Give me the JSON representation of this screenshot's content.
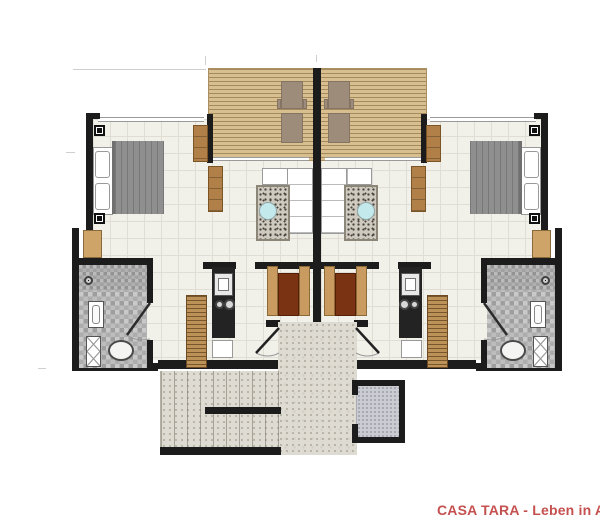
{
  "branding": {
    "title": "CASA TARA - Leben in Asien",
    "color": "#c4514f"
  },
  "palette": {
    "wall": "#1c1c1c",
    "floor": "#f2f1e9",
    "floor_grid": "#e0ded4",
    "deck_wood": "#d8bf8f",
    "lounger": "#9c8c79",
    "furniture_wood": "#b08048",
    "ladder_wood": "#bd9258",
    "table_wood": "#7b3413",
    "bench_wood": "#c99b60",
    "closet_wood": "#cfa468",
    "bed_blanket": "#8f8f8f",
    "rug_base": "#cfcabf",
    "rug_dot": "#45403a",
    "coffee_table": "#c4e9ec",
    "bath_tile_a": "#9e9e9e",
    "bath_tile_b": "#c9c9c9",
    "stone": "#dedbd2",
    "stone_dot": "#b7b3a7",
    "shower_room": "#caccd2",
    "counter": "#232323",
    "accent": "#c4514f",
    "fixture_line": "#555555"
  },
  "legend": {
    "drawing_type": "twin-unit floor plan, mirrored about center wall",
    "icons": {
      "wall-symbol-icon": "black square with white ring (column/AC point)",
      "shower-head-icon": "dark ring with center dot",
      "door-icon": "diagonal leaf with quarter-circle swing arc"
    }
  }
}
